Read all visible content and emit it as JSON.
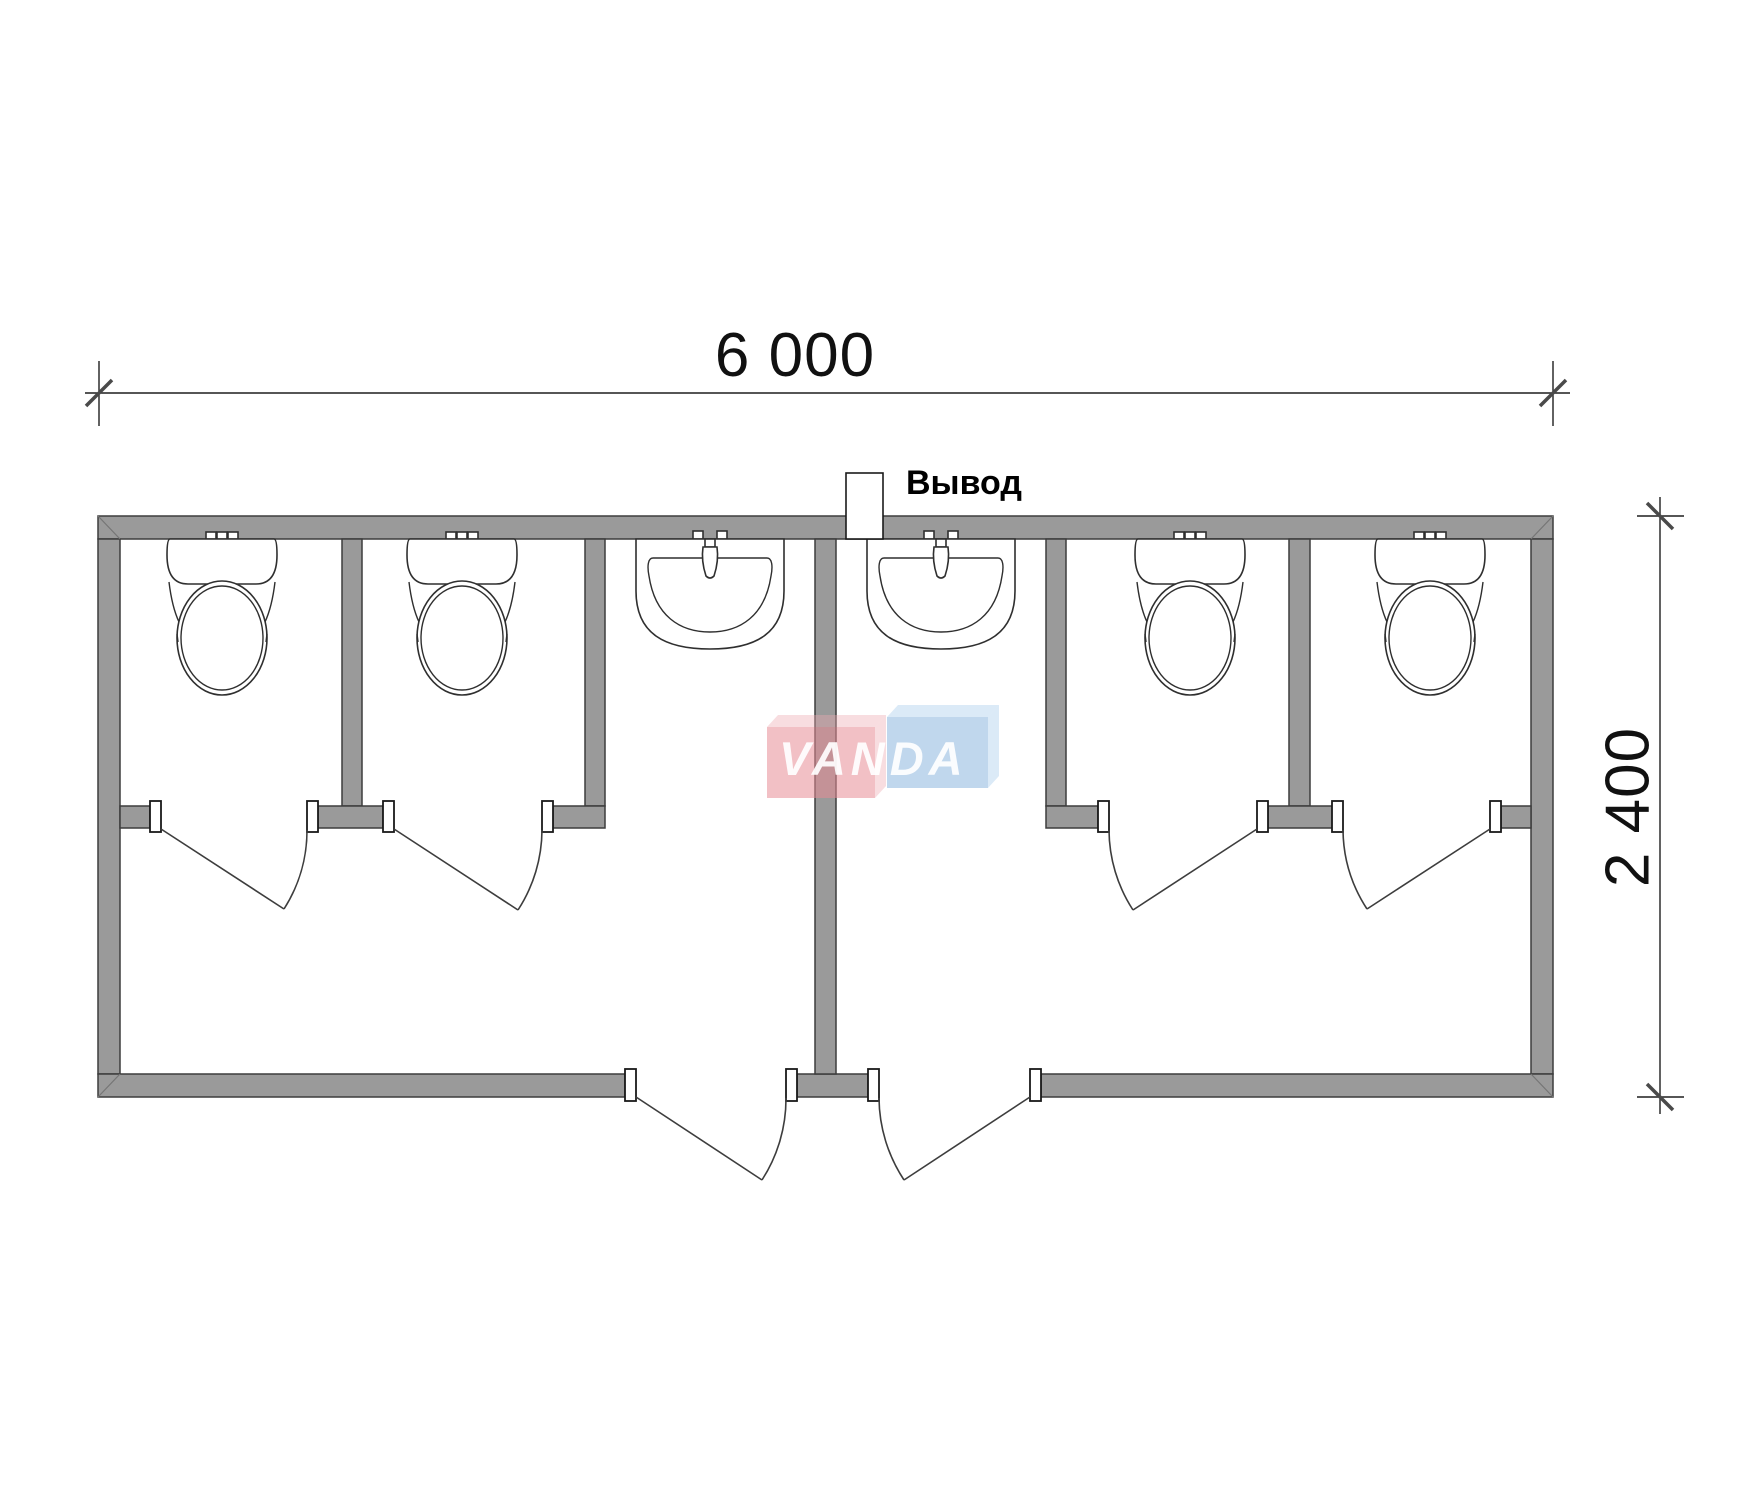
{
  "labels": {
    "width_dimension": "6 000",
    "height_dimension": "2 400",
    "outlet": "Вывод",
    "watermark": "VANDA"
  },
  "colors": {
    "wall_fill": "#9a9a9a",
    "line_dark": "#3d3d3d",
    "dimension_text": "#111111",
    "logo_pink": "rgba(231,140,150,0.55)",
    "logo_pink_light": "rgba(238,170,178,0.40)",
    "logo_blue": "rgba(130,175,220,0.50)",
    "logo_blue_light": "rgba(160,200,235,0.38)",
    "watermark_text": "rgba(255,255,255,0.92)"
  },
  "fixtures": {
    "toilet_count": 4,
    "sink_count": 2
  }
}
